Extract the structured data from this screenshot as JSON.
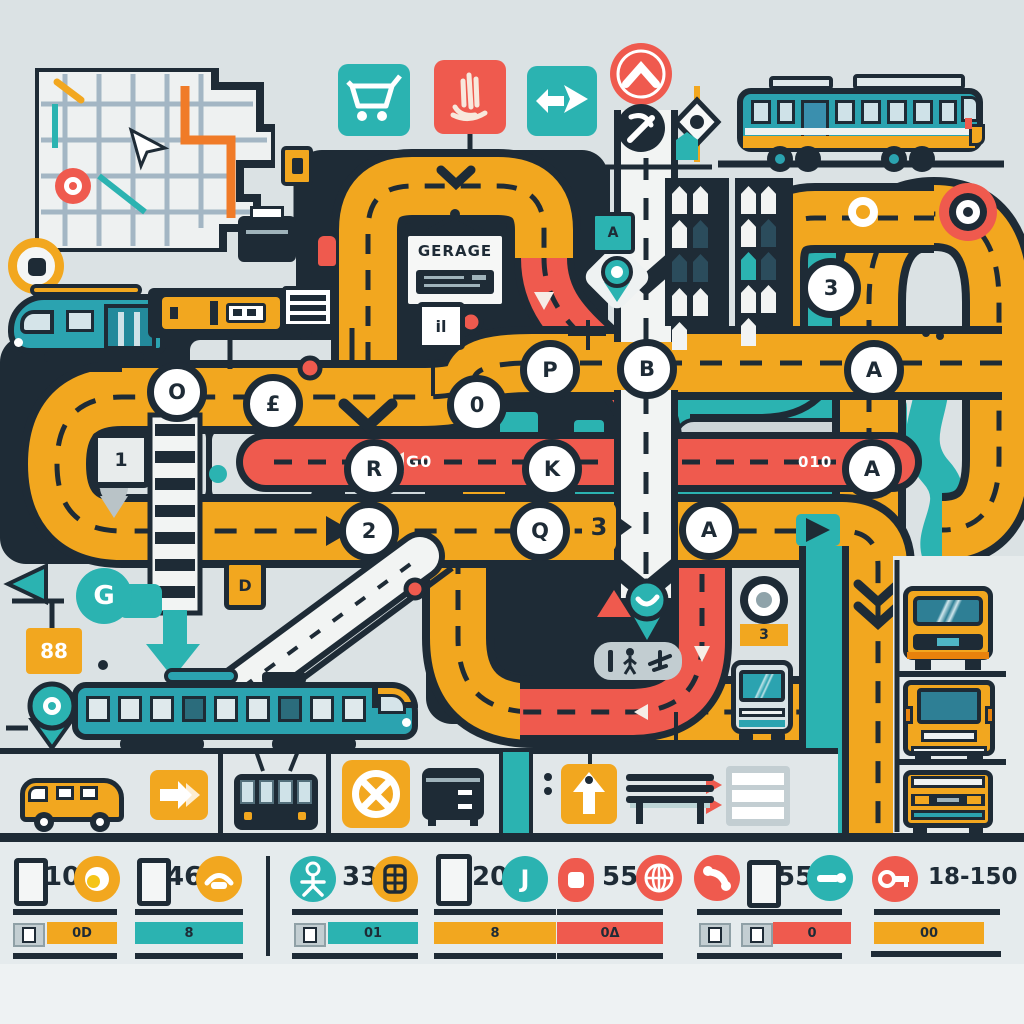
{
  "palette": {
    "dark": "#1E2B36",
    "yellow": "#F2A71F",
    "red": "#EF5A4E",
    "teal": "#2BB3B1",
    "bg": "#DBE2E4",
    "road_white": "#F2F4F3"
  },
  "signs": {
    "garage": "GERAGE",
    "under_garage": "il",
    "teal_square": "A",
    "route_flag": "1",
    "d_tag": "D",
    "double_eight": "88",
    "g_badge": "G",
    "bus_stop_tag": "3",
    "route_tag": "3",
    "red_left_label": "G0",
    "red_right_label": "010",
    "j_glyph": "J"
  },
  "stations": [
    {
      "label": "O"
    },
    {
      "label": "£"
    },
    {
      "label": "0"
    },
    {
      "label": "P"
    },
    {
      "label": "B"
    },
    {
      "label": "R"
    },
    {
      "label": "K"
    },
    {
      "label": "2"
    },
    {
      "label": "Q"
    },
    {
      "label": "A"
    },
    {
      "label": "3"
    },
    {
      "label": "A"
    },
    {
      "label": "A"
    }
  ],
  "legend": {
    "cells": [
      {
        "value": "10",
        "bar": "0D"
      },
      {
        "value": "46",
        "bar": "8"
      },
      {
        "value": "33",
        "bar": "01"
      },
      {
        "value": "20",
        "bar": "8"
      },
      {
        "value": "55",
        "bar": "0Δ"
      },
      {
        "value": "55",
        "bar": "0"
      },
      {
        "value": "18-150",
        "bar": "00"
      }
    ]
  },
  "icons": [
    "city-map",
    "shopping-cart",
    "hand",
    "double-arrow",
    "up-chevron-sign",
    "tools-station",
    "eye-diamond",
    "bus-side",
    "tram-front",
    "tram-side",
    "bus-front",
    "trolleybus-front",
    "van-side",
    "truck-front",
    "location-pin",
    "target-roundabout",
    "no-entry",
    "right-arrow-sign",
    "up-arrow-sign",
    "bench",
    "list-sign",
    "person",
    "globe",
    "phone",
    "key",
    "crosswalk",
    "escalator-road"
  ]
}
